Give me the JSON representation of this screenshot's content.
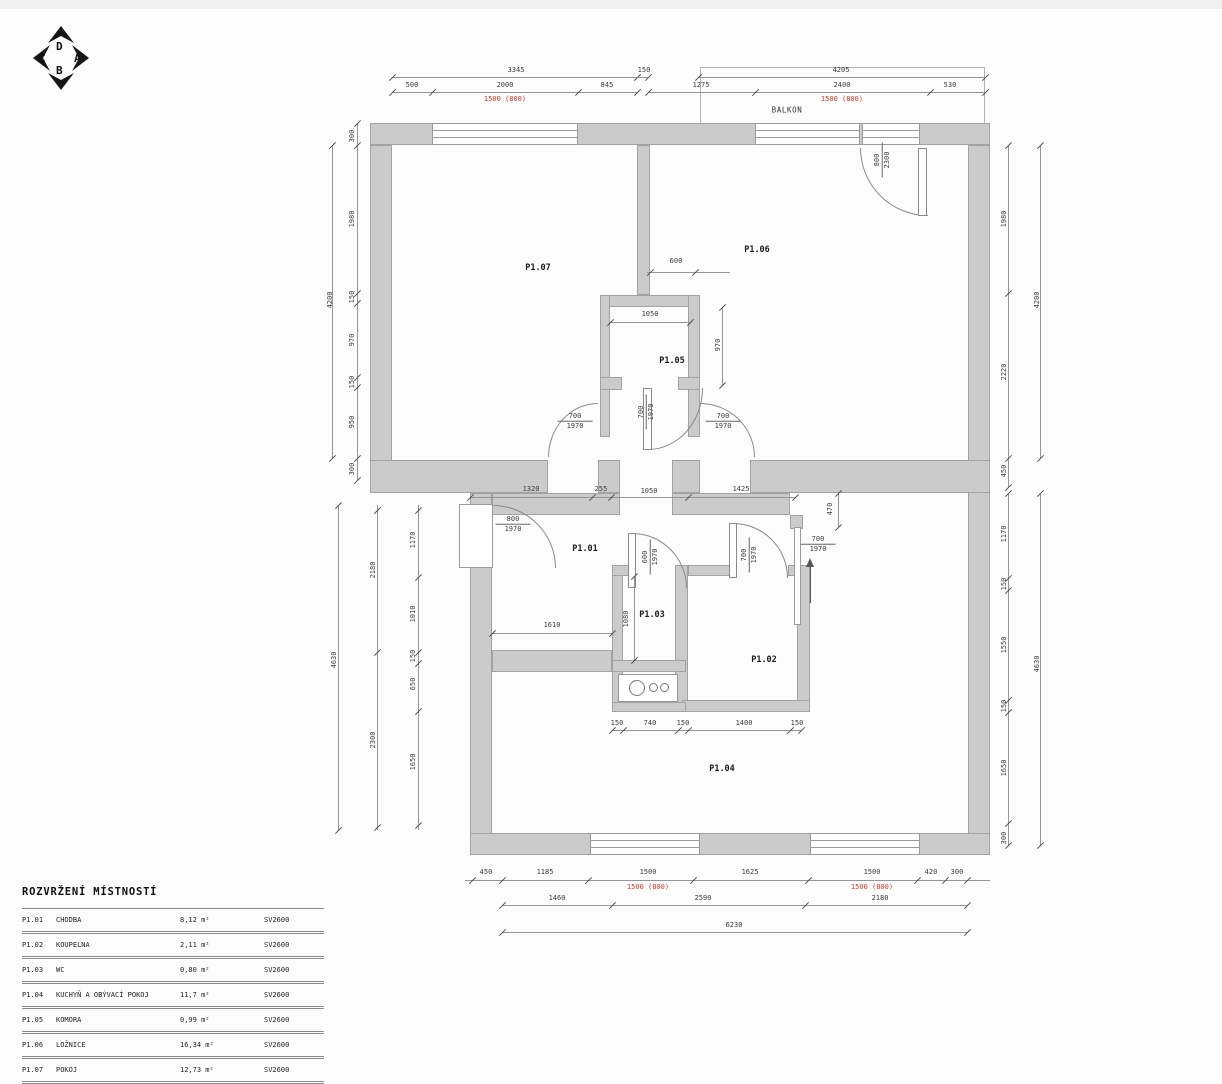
{
  "colors": {
    "dimension_red": "#c9392b",
    "wall_fill": "#cccbcb"
  },
  "compass": {
    "top": "D",
    "left": "C",
    "right": "A",
    "bottom": "B"
  },
  "plan": {
    "balcony_label": "BALKON",
    "room_labels": [
      {
        "t": "P1.07",
        "x": 538,
        "y": 268
      },
      {
        "t": "P1.06",
        "x": 757,
        "y": 250
      },
      {
        "t": "P1.05",
        "x": 672,
        "y": 361
      },
      {
        "t": "P1.01",
        "x": 585,
        "y": 549
      },
      {
        "t": "P1.03",
        "x": 652,
        "y": 615
      },
      {
        "t": "P1.02",
        "x": 764,
        "y": 660
      },
      {
        "t": "P1.04",
        "x": 722,
        "y": 769
      }
    ],
    "door_labels": [
      {
        "top": "700",
        "bottom": "1970",
        "x": 575,
        "y": 421,
        "rot": false
      },
      {
        "top": "700",
        "bottom": "1970",
        "x": 646,
        "y": 412,
        "rot": true
      },
      {
        "top": "700",
        "bottom": "1970",
        "x": 723,
        "y": 421,
        "rot": false
      },
      {
        "top": "800",
        "bottom": "2300",
        "x": 882,
        "y": 160,
        "rot": true
      },
      {
        "top": "800",
        "bottom": "1970",
        "x": 513,
        "y": 524,
        "rot": false
      },
      {
        "top": "600",
        "bottom": "1970",
        "x": 650,
        "y": 557,
        "rot": true
      },
      {
        "top": "700",
        "bottom": "1970",
        "x": 749,
        "y": 555,
        "rot": true
      },
      {
        "top": "700",
        "bottom": "1970",
        "x": 818,
        "y": 544,
        "rot": false
      }
    ],
    "dim_labels": [
      {
        "t": "3345",
        "x": 516,
        "y": 70
      },
      {
        "t": "150",
        "x": 644,
        "y": 70
      },
      {
        "t": "500",
        "x": 412,
        "y": 85
      },
      {
        "t": "2000",
        "x": 505,
        "y": 85
      },
      {
        "t": "845",
        "x": 607,
        "y": 85
      },
      {
        "t": "1500 (800)",
        "x": 505,
        "y": 99,
        "red": true
      },
      {
        "t": "4205",
        "x": 841,
        "y": 70
      },
      {
        "t": "1275",
        "x": 701,
        "y": 85
      },
      {
        "t": "2400",
        "x": 842,
        "y": 85
      },
      {
        "t": "530",
        "x": 950,
        "y": 85
      },
      {
        "t": "1500 (800)",
        "x": 842,
        "y": 99,
        "red": true
      },
      {
        "t": "300",
        "x": 352,
        "y": 136,
        "rot": true
      },
      {
        "t": "1980",
        "x": 352,
        "y": 219,
        "rot": true
      },
      {
        "t": "150",
        "x": 352,
        "y": 297,
        "rot": true
      },
      {
        "t": "970",
        "x": 352,
        "y": 340,
        "rot": true
      },
      {
        "t": "150",
        "x": 352,
        "y": 382,
        "rot": true
      },
      {
        "t": "950",
        "x": 352,
        "y": 422,
        "rot": true
      },
      {
        "t": "300",
        "x": 352,
        "y": 469,
        "rot": true
      },
      {
        "t": "4200",
        "x": 330,
        "y": 300,
        "rot": true
      },
      {
        "t": "1170",
        "x": 413,
        "y": 540,
        "rot": true
      },
      {
        "t": "1010",
        "x": 413,
        "y": 614,
        "rot": true
      },
      {
        "t": "150",
        "x": 413,
        "y": 656,
        "rot": true
      },
      {
        "t": "650",
        "x": 413,
        "y": 684,
        "rot": true
      },
      {
        "t": "1650",
        "x": 413,
        "y": 762,
        "rot": true
      },
      {
        "t": "2180",
        "x": 373,
        "y": 570,
        "rot": true
      },
      {
        "t": "2300",
        "x": 373,
        "y": 740,
        "rot": true
      },
      {
        "t": "4630",
        "x": 334,
        "y": 660,
        "rot": true
      },
      {
        "t": "1980",
        "x": 1004,
        "y": 219,
        "rot": true
      },
      {
        "t": "2220",
        "x": 1004,
        "y": 372,
        "rot": true
      },
      {
        "t": "450",
        "x": 1004,
        "y": 471,
        "rot": true
      },
      {
        "t": "4200",
        "x": 1037,
        "y": 300,
        "rot": true
      },
      {
        "t": "1170",
        "x": 1004,
        "y": 534,
        "rot": true
      },
      {
        "t": "150",
        "x": 1004,
        "y": 584,
        "rot": true
      },
      {
        "t": "1550",
        "x": 1004,
        "y": 645,
        "rot": true
      },
      {
        "t": "150",
        "x": 1004,
        "y": 706,
        "rot": true
      },
      {
        "t": "1650",
        "x": 1004,
        "y": 768,
        "rot": true
      },
      {
        "t": "300",
        "x": 1004,
        "y": 838,
        "rot": true
      },
      {
        "t": "4630",
        "x": 1037,
        "y": 664,
        "rot": true
      },
      {
        "t": "1320",
        "x": 531,
        "y": 489
      },
      {
        "t": "255",
        "x": 601,
        "y": 489
      },
      {
        "t": "1050",
        "x": 649,
        "y": 491
      },
      {
        "t": "1425",
        "x": 741,
        "y": 489
      },
      {
        "t": "600",
        "x": 676,
        "y": 261
      },
      {
        "t": "1050",
        "x": 650,
        "y": 314
      },
      {
        "t": "970",
        "x": 718,
        "y": 345,
        "rot": true
      },
      {
        "t": "470",
        "x": 830,
        "y": 509,
        "rot": true
      },
      {
        "t": "1610",
        "x": 552,
        "y": 625
      },
      {
        "t": "1080",
        "x": 626,
        "y": 619,
        "rot": true
      },
      {
        "t": "150",
        "x": 617,
        "y": 723
      },
      {
        "t": "740",
        "x": 650,
        "y": 723
      },
      {
        "t": "150",
        "x": 683,
        "y": 723
      },
      {
        "t": "1400",
        "x": 744,
        "y": 723
      },
      {
        "t": "150",
        "x": 797,
        "y": 723
      },
      {
        "t": "450",
        "x": 486,
        "y": 872
      },
      {
        "t": "1185",
        "x": 545,
        "y": 872
      },
      {
        "t": "1500",
        "x": 648,
        "y": 872
      },
      {
        "t": "1625",
        "x": 750,
        "y": 872
      },
      {
        "t": "1500",
        "x": 872,
        "y": 872
      },
      {
        "t": "420",
        "x": 931,
        "y": 872
      },
      {
        "t": "300",
        "x": 957,
        "y": 872
      },
      {
        "t": "1500 (800)",
        "x": 648,
        "y": 887,
        "red": true
      },
      {
        "t": "1500 (800)",
        "x": 872,
        "y": 887,
        "red": true
      },
      {
        "t": "1460",
        "x": 557,
        "y": 898
      },
      {
        "t": "2590",
        "x": 703,
        "y": 898
      },
      {
        "t": "2180",
        "x": 880,
        "y": 898
      },
      {
        "t": "6230",
        "x": 734,
        "y": 925
      }
    ]
  },
  "legend": {
    "title": "ROZVRŽENÍ MÍSTNOSTÍ",
    "rows": [
      {
        "id": "P1.01",
        "name": "CHODBA",
        "area": "8,12 m²",
        "code": "SV2600"
      },
      {
        "id": "P1.02",
        "name": "KOUPELNA",
        "area": "2,11 m²",
        "code": "SV2600"
      },
      {
        "id": "P1.03",
        "name": "WC",
        "area": "0,80 m²",
        "code": "SV2600"
      },
      {
        "id": "P1.04",
        "name": "KUCHYŇ A OBÝVACÍ POKOJ",
        "area": "11,7 m²",
        "code": "SV2600"
      },
      {
        "id": "P1.05",
        "name": "KOMORA",
        "area": "0,99 m²",
        "code": "SV2600"
      },
      {
        "id": "P1.06",
        "name": "LOŽNICE",
        "area": "16,34 m²",
        "code": "SV2600"
      },
      {
        "id": "P1.07",
        "name": "POKOJ",
        "area": "12,73 m²",
        "code": "SV2600"
      }
    ]
  }
}
